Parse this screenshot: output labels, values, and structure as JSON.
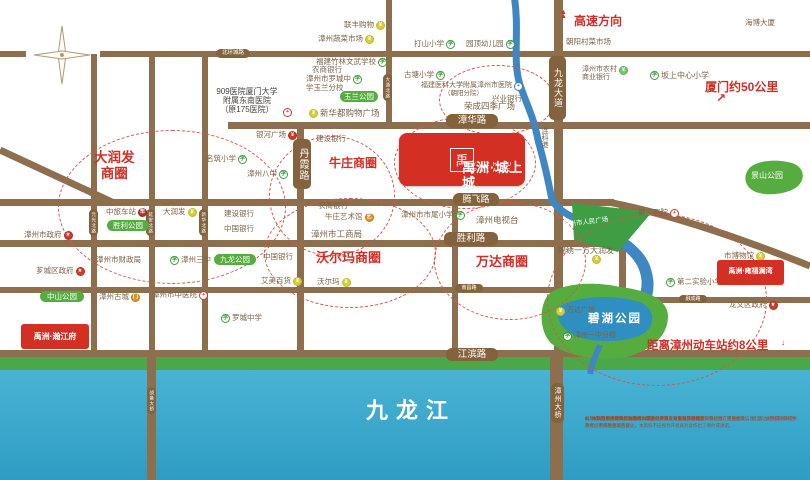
{
  "project": {
    "name": "禹洲·城上城",
    "name_en": "YUZHOU PALACE",
    "logo_glyph": "禹"
  },
  "side_projects": [
    {
      "t": "禹洲·雍禧澜湾",
      "x": 717,
      "y": 260,
      "w": 67,
      "h": 25,
      "deco": "top"
    },
    {
      "t": "禹洲·瀚江府",
      "x": 21,
      "y": 324,
      "w": 68,
      "h": 25,
      "deco": "bottom"
    }
  ],
  "river": {
    "name": "九龙江",
    "canal": "连科港"
  },
  "roads_h": [
    {
      "x": 0,
      "y": 51,
      "w": 26,
      "h": 6
    },
    {
      "x": 100,
      "y": 51,
      "w": 710,
      "h": 6
    },
    {
      "x": 228,
      "y": 122,
      "w": 582,
      "h": 7
    },
    {
      "x": 0,
      "y": 199,
      "w": 614,
      "h": 7
    },
    {
      "x": 0,
      "y": 240,
      "w": 614,
      "h": 7
    },
    {
      "x": 0,
      "y": 287,
      "w": 562,
      "h": 6
    },
    {
      "x": 0,
      "y": 350,
      "w": 810,
      "h": 7
    },
    {
      "x": 648,
      "y": 297,
      "w": 162,
      "h": 6
    }
  ],
  "roads_v": [
    {
      "x": 91,
      "y": 54,
      "w": 6,
      "h": 300
    },
    {
      "x": 149,
      "y": 54,
      "w": 6,
      "h": 300
    },
    {
      "x": 202,
      "y": 54,
      "w": 6,
      "h": 300
    },
    {
      "x": 297,
      "y": 124,
      "w": 7,
      "h": 230
    },
    {
      "x": 386,
      "y": 0,
      "w": 6,
      "h": 124
    },
    {
      "x": 452,
      "y": 201,
      "w": 6,
      "h": 152
    },
    {
      "x": 554,
      "y": 0,
      "w": 9,
      "h": 353
    },
    {
      "x": 619,
      "y": 202,
      "w": 7,
      "h": 97
    }
  ],
  "bridges": [
    {
      "x": 147,
      "y": 350,
      "w": 9,
      "h": 130
    },
    {
      "x": 550,
      "y": 350,
      "w": 13,
      "h": 130
    }
  ],
  "road_badges": [
    {
      "t": "北环城路",
      "x": 216,
      "y": 49,
      "w": 34,
      "h": 9,
      "fs": 5.5
    },
    {
      "t": "漳华路",
      "x": 446,
      "y": 114,
      "w": 52,
      "h": 14,
      "fs": 9.5
    },
    {
      "t": "腾飞路",
      "x": 453,
      "y": 193,
      "w": 46,
      "h": 13,
      "fs": 9
    },
    {
      "t": "胜利路",
      "x": 444,
      "y": 232,
      "w": 54,
      "h": 14,
      "fs": 9.5
    },
    {
      "t": "南昌路",
      "x": 455,
      "y": 284,
      "w": 28,
      "h": 8,
      "fs": 5
    },
    {
      "t": "融成路",
      "x": 679,
      "y": 295,
      "w": 28,
      "h": 8,
      "fs": 5
    },
    {
      "t": "江滨路",
      "x": 446,
      "y": 348,
      "w": 52,
      "h": 13,
      "fs": 9.5
    },
    {
      "t": "丹霞路",
      "x": 293,
      "y": 139,
      "w": 18,
      "h": 50,
      "fs": 10,
      "v": 1
    },
    {
      "t": "九龙大道",
      "x": 549,
      "y": 56,
      "w": 17,
      "h": 64,
      "fs": 9,
      "v": 1
    },
    {
      "t": "漳州大桥",
      "x": 551,
      "y": 383,
      "w": 13,
      "h": 40,
      "fs": 7,
      "v": 1
    },
    {
      "t": "元光北路",
      "x": 89,
      "y": 209,
      "w": 9,
      "h": 27,
      "fs": 4.5,
      "v": 1
    },
    {
      "t": "延安北路",
      "x": 146,
      "y": 209,
      "w": 9,
      "h": 27,
      "fs": 4.5,
      "v": 1
    },
    {
      "t": "新华北路",
      "x": 199,
      "y": 209,
      "w": 9,
      "h": 27,
      "fs": 4.5,
      "v": 1
    },
    {
      "t": "大通北路",
      "x": 383,
      "y": 74,
      "w": 9,
      "h": 27,
      "fs": 4.5,
      "v": 1
    },
    {
      "t": "战备大桥",
      "x": 147,
      "y": 387,
      "w": 9,
      "h": 27,
      "fs": 4.5,
      "v": 1
    }
  ],
  "dashed_circles": [
    {
      "cx": 172,
      "cy": 207,
      "rx": 114,
      "ry": 77
    },
    {
      "cx": 332,
      "cy": 196,
      "rx": 63,
      "ry": 60
    },
    {
      "cx": 350,
      "cy": 253,
      "rx": 86,
      "ry": 55
    },
    {
      "cx": 510,
      "cy": 261,
      "rx": 76,
      "ry": 59
    },
    {
      "cx": 465,
      "cy": 163,
      "rx": 71,
      "ry": 46
    },
    {
      "cx": 497,
      "cy": 100,
      "rx": 58,
      "ry": 35
    },
    {
      "cx": 657,
      "cy": 300,
      "rx": 110,
      "ry": 86
    }
  ],
  "circle_labels": [
    {
      "lines": [
        "大润发",
        "商圈"
      ],
      "x": 94,
      "y": 150,
      "size": 13.5
    },
    {
      "lines": [
        "牛庄商圈"
      ],
      "x": 329,
      "y": 157,
      "size": 12
    },
    {
      "lines": [
        "沃尔玛商圈"
      ],
      "x": 316,
      "y": 251,
      "size": 13
    },
    {
      "lines": [
        "万达商圈"
      ],
      "x": 476,
      "y": 255,
      "size": 13
    }
  ],
  "park_badges": [
    {
      "t": "玉兰公园",
      "x": 340,
      "y": 91,
      "w": 38,
      "h": 11
    },
    {
      "t": "胜利公园",
      "x": 107,
      "y": 220,
      "w": 42,
      "h": 11
    },
    {
      "t": "九龙公园",
      "x": 214,
      "y": 254,
      "w": 42,
      "h": 11
    },
    {
      "t": "中山公园",
      "x": 40,
      "y": 291,
      "w": 44,
      "h": 11
    }
  ],
  "white_texts": [
    {
      "t": "景山公园",
      "x": 751,
      "y": 172,
      "size": 8
    },
    {
      "t": "碧湖公园",
      "x": 588,
      "y": 313,
      "size": 11.5,
      "ls": 2,
      "bold": true
    },
    {
      "t": "漳州市人民广场",
      "x": 563,
      "y": 219,
      "size": 6.5,
      "rot": -7
    },
    {
      "t": "九龙江",
      "x": 366,
      "y": 399,
      "size": 22,
      "ls": 8,
      "bold": true
    }
  ],
  "red_notes": [
    {
      "t": "高速方向",
      "x": 574,
      "y": 15,
      "size": 12
    },
    {
      "t": "厦门约50公里",
      "x": 705,
      "y": 81,
      "size": 12
    },
    {
      "t": "距离漳州动车站约8公里",
      "x": 647,
      "y": 340,
      "size": 11.5
    }
  ],
  "arrows": [
    {
      "t": "▲",
      "x": 560,
      "y": 11,
      "size": 7,
      "stack": true
    },
    {
      "t": "↗",
      "x": 716,
      "y": 95,
      "size": 12
    },
    {
      "t": "↓",
      "x": 781,
      "y": 341,
      "size": 8
    }
  ],
  "canal_label": {
    "t": "连科港",
    "x": 539,
    "y": 127
  },
  "pois": [
    {
      "t": "联丰购物",
      "x": 344,
      "y": 21,
      "ic": "shop",
      "side": "r"
    },
    {
      "t": "漳州蔬菜市场",
      "x": 318,
      "y": 35,
      "ic": "shop",
      "side": "r"
    },
    {
      "t": "打山小学",
      "x": 414,
      "y": 40,
      "ic": "school",
      "side": "r"
    },
    {
      "t": "园顶幼儿园",
      "x": 466,
      "y": 40,
      "ic": "school",
      "side": "r"
    },
    {
      "t": "福建竹林文武学校",
      "x": 316,
      "y": 58,
      "ic": "school",
      "side": "r"
    },
    {
      "t": "农商银行",
      "x": 312,
      "y": 66
    },
    {
      "t": "漳州市罗城中|学玉兰分校",
      "x": 306,
      "y": 75,
      "ic": "school",
      "side": "r"
    },
    {
      "t": "古塘小学",
      "x": 404,
      "y": 71,
      "ic": "school",
      "side": "r"
    },
    {
      "t": "福建医科大学附属漳州市医院",
      "x": 421,
      "y": 82,
      "ic": "hospital_blue",
      "side": "r",
      "size": 7
    },
    {
      "t": "（朝阳分院）",
      "x": 444,
      "y": 90,
      "size": 6.5
    },
    {
      "t": "兴业银行",
      "x": 492,
      "y": 95
    },
    {
      "t": "荣成四季广场",
      "x": 464,
      "y": 102,
      "size": 8.5
    },
    {
      "t": "新华都购物广场",
      "x": 309,
      "y": 109,
      "ic": "shop",
      "side": "l",
      "size": 8.5
    },
    {
      "t": "909医院厦门大学|附属东南医院|（原175医院）",
      "x": 210,
      "y": 87,
      "color": "#45413c",
      "size": 8,
      "align": "center",
      "w": 74
    },
    {
      "t": "",
      "x": 283,
      "y": 108,
      "ic": "hospital",
      "side": "only"
    },
    {
      "t": "海博大厦",
      "x": 745,
      "y": 19
    },
    {
      "t": "朝阳村菜市场",
      "x": 566,
      "y": 38
    },
    {
      "t": "漳州市农村|商业银行",
      "x": 582,
      "y": 66,
      "ic": "shop_green",
      "side": "r",
      "size": 7
    },
    {
      "t": "坂上中心小学",
      "x": 650,
      "y": 71,
      "ic": "school",
      "side": "l",
      "size": 8
    },
    {
      "t": "银河广场",
      "x": 256,
      "y": 131,
      "ic": "shop_red",
      "side": "r"
    },
    {
      "t": "建设银行",
      "x": 316,
      "y": 135
    },
    {
      "t": "名筑小学",
      "x": 206,
      "y": 155,
      "ic": "school",
      "side": "r"
    },
    {
      "t": "漳州八中",
      "x": 247,
      "y": 170,
      "ic": "school",
      "side": "r"
    },
    {
      "t": "中旅车站",
      "x": 106,
      "y": 208,
      "ic": "bus",
      "side": "r"
    },
    {
      "t": "大润发",
      "x": 163,
      "y": 208,
      "ic": "shop",
      "side": "r"
    },
    {
      "t": "建设银行",
      "x": 224,
      "y": 210
    },
    {
      "t": "中国银行",
      "x": 224,
      "y": 225
    },
    {
      "t": "漳州市政府",
      "x": 24,
      "y": 231,
      "ic": "gov",
      "side": "r"
    },
    {
      "t": "漳州市财政局",
      "x": 96,
      "y": 256
    },
    {
      "t": "漳州三中",
      "x": 170,
      "y": 256,
      "ic": "school",
      "side": "l"
    },
    {
      "t": "芗城区政府",
      "x": 36,
      "y": 267,
      "ic": "gov",
      "side": "r"
    },
    {
      "t": "漳州古城",
      "x": 99,
      "y": 293,
      "ic": "gate",
      "side": "r"
    },
    {
      "t": "漳州市中医院",
      "x": 152,
      "y": 291,
      "ic": "hospital",
      "side": "r"
    },
    {
      "t": "罗城中学",
      "x": 221,
      "y": 314,
      "ic": "school",
      "side": "l"
    },
    {
      "t": "农商银行",
      "x": 318,
      "y": 202
    },
    {
      "t": "牛庄艺术馆",
      "x": 325,
      "y": 213,
      "ic": "art",
      "side": "r"
    },
    {
      "t": "漳州市工商局",
      "x": 311,
      "y": 230,
      "size": 8.5
    },
    {
      "t": "中国银行",
      "x": 263,
      "y": 253
    },
    {
      "t": "艾美百货",
      "x": 261,
      "y": 277,
      "ic": "shop",
      "side": "r"
    },
    {
      "t": "沃尔玛",
      "x": 317,
      "y": 278,
      "ic": "shop",
      "side": "r"
    },
    {
      "t": "漳州市市尾小学",
      "x": 401,
      "y": 211,
      "ic": "school",
      "side": "r"
    },
    {
      "t": "漳州电视台",
      "x": 476,
      "y": 216,
      "size": 8.5
    },
    {
      "t": "第三医院",
      "x": 638,
      "y": 209,
      "ic": "hospital",
      "side": "r"
    },
    {
      "t": "锦绣一方大润发",
      "x": 558,
      "y": 246,
      "size": 8
    },
    {
      "t": "",
      "x": 592,
      "y": 255,
      "ic": "shop",
      "side": "only"
    },
    {
      "t": "市博物馆",
      "x": 724,
      "y": 252,
      "ic": "shop",
      "side": "r"
    },
    {
      "t": "第二实验小学",
      "x": 666,
      "y": 278,
      "ic": "school",
      "side": "l"
    },
    {
      "t": "龙文区政府",
      "x": 729,
      "y": 301,
      "ic": "gov",
      "side": "r"
    },
    {
      "t": "万达广场",
      "x": 556,
      "y": 307,
      "ic": "shop",
      "side": "l",
      "size": 7
    },
    {
      "t": "漳州一中分校",
      "x": 563,
      "y": 332,
      "ic": "school",
      "side": "l",
      "size": 7
    }
  ],
  "disclaimer": {
    "title": "温馨提示：",
    "lines": [
      "1、本商业广告内的所有图片（包括但不限于效果图、鸟瞰图、设计图、平面图等）、模型、文字描述等仅供参考，不作为合同内容。",
      "2、本资料中对项目周边环境、交通、教育、商业及其他配套的介绍旨在提供相关信息，周边规划不排除因政府规划调整而发生变化，本资料不应视为开发商对此作出了要约或承诺。",
      "3、本资料制作时间：2008年09月。",
      "4、本广告最终解释权归漳州禹洲房地产开发有限公司所有。",
      "5、本广告宣传资料如有变动以政府批文为准，敬请留意最新资料。"
    ]
  }
}
